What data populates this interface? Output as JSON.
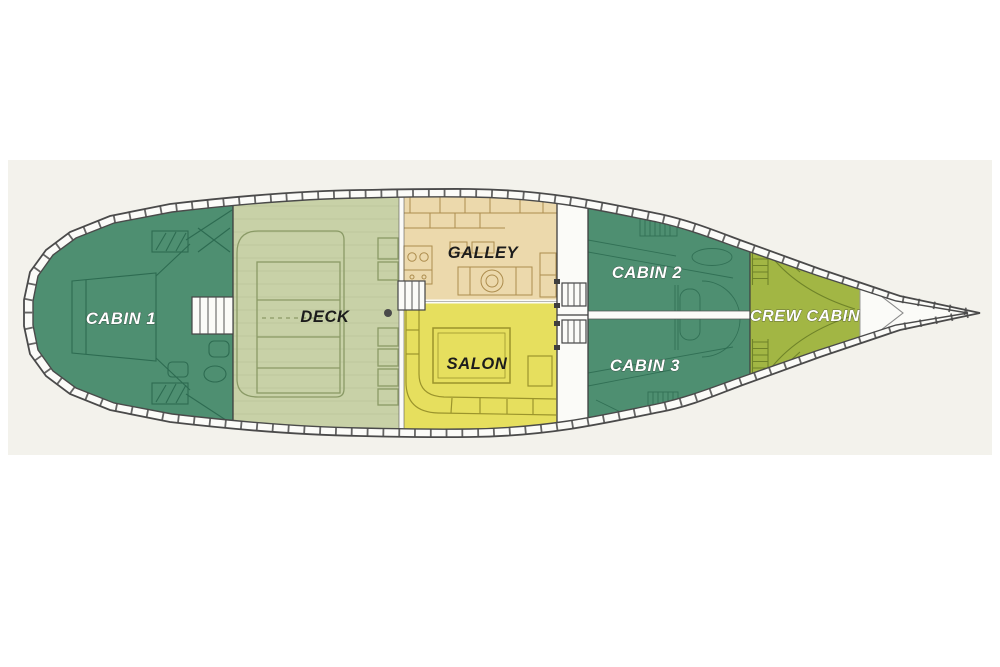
{
  "floorplan": {
    "band_background": "#f3f2ec",
    "hull": {
      "outline_color": "#4a4a4a",
      "deck_white": "#fbfbf8"
    },
    "sections": [
      {
        "id": "cabin1",
        "label": "CABIN 1",
        "fill": "#4e8f71",
        "label_color": "#ffffff"
      },
      {
        "id": "deck",
        "label": "DECK",
        "fill": "#c8d1a7",
        "label_color": "#1c1c1c"
      },
      {
        "id": "galley",
        "label": "GALLEY",
        "fill": "#ecd9ac",
        "label_color": "#1c1c1c"
      },
      {
        "id": "salon",
        "label": "SALON",
        "fill": "#e6df5e",
        "label_color": "#1c1c1c"
      },
      {
        "id": "cabin2",
        "label": "CABIN 2",
        "fill": "#4e8f71",
        "label_color": "#ffffff"
      },
      {
        "id": "cabin3",
        "label": "CABIN 3",
        "fill": "#4e8f71",
        "label_color": "#ffffff"
      },
      {
        "id": "crew_cabin",
        "label": "CREW CABIN",
        "fill": "#a2b644",
        "label_color": "#ffffff"
      }
    ]
  }
}
